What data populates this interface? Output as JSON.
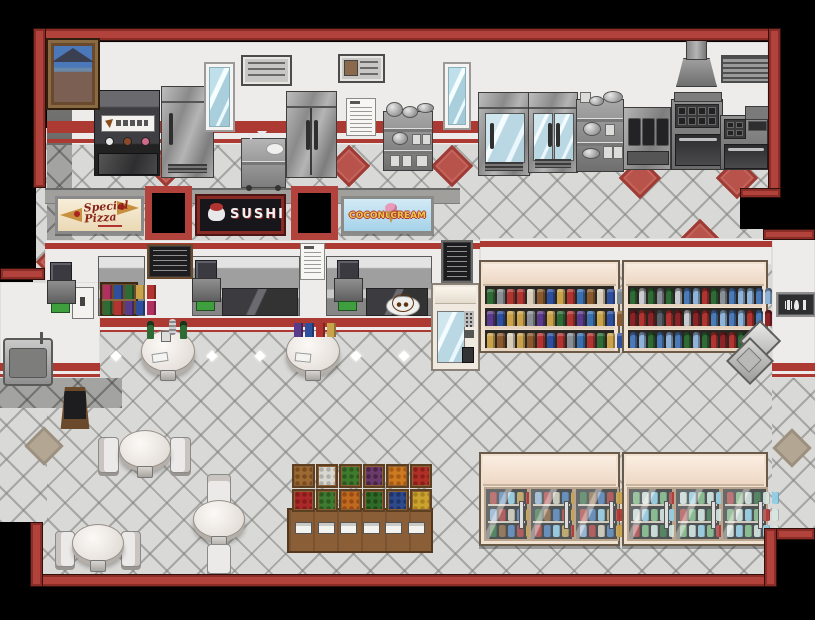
{
  "signs": {
    "pizza_line1": "Special",
    "pizza_line2": "Pizza",
    "sushi": "SUSHI",
    "icecream_left": "COCONUT",
    "icecream_right": "CREAM"
  },
  "palette": {
    "border_red": "#b2423c",
    "stripe_red": "#ad3a32",
    "wall_white": "#edecea",
    "floor_tile": "#d9d9d7",
    "dark_floor": "#a3a3a1",
    "wood": "#8a5f38",
    "shelf_frame": "#efe0d0",
    "chalkboard": "#1d1d1f",
    "steel": "#9a9a9a",
    "accent_diamond": "#b8534b"
  },
  "icons": {
    "wall_plaque_icons": [
      "fork-icon",
      "spoon-icon",
      "knife-icon"
    ],
    "icecream_machine_buttons": [
      "vanilla",
      "chocolate",
      "strawberry"
    ],
    "pizza_sign_icon": "pizza-slice-icon",
    "sushi_sign_icon": "sushi-icon",
    "icecream_sign_icon": "ice-cream-cone-icon"
  },
  "shop": {
    "grocery_shelf_rows": [
      [
        "#2e6b35",
        "#8a8f96",
        "#b23430",
        "#b23430",
        "#d8cdb8",
        "#8a5a2e",
        "#2e4f9e",
        "#caa24a",
        "#b23430",
        "#3a6fb0",
        "#8a5a2e",
        "#d8cdb8",
        "#2e4f9e",
        "#7a8894",
        "#b23430"
      ],
      [
        "#5a3a8a",
        "#2e4f9e",
        "#caa24a",
        "#caa24a",
        "#8a8f96",
        "#5a3a8a",
        "#caa24a",
        "#2e6b35",
        "#b23430",
        "#5a3a8a",
        "#3a6fb0",
        "#caa24a",
        "#2e4f9e",
        "#8a5a2e",
        "#b23430"
      ],
      [
        "#caa24a",
        "#8a5a2e",
        "#d8cdb8",
        "#caa24a",
        "#8a5a2e",
        "#b23430",
        "#2e4f9e",
        "#b23430",
        "#8a8f96",
        "#3a6fb0",
        "#b23430",
        "#2e6b35",
        "#caa24a",
        "#2e4f9e",
        "#b23430"
      ]
    ],
    "drink_shelf_rows": [
      [
        "#2e6b35",
        "#c8ccd0",
        "#2e6b35",
        "#8a9098",
        "#2e6b35",
        "#c8ccd0",
        "#4a7ab8",
        "#8fb2d8",
        "#b23430",
        "#2e6b35",
        "#8a9098",
        "#4a7ab8",
        "#8fb2d8",
        "#8fb2d8",
        "#4a7ab8",
        "#8fb2d8"
      ],
      [
        "#8a2328",
        "#b23430",
        "#8a2328",
        "#5a6068",
        "#b23430",
        "#8a2328",
        "#c8ccd0",
        "#8a2328",
        "#b23430",
        "#4a7ab8",
        "#8fb2d8",
        "#4a7ab8",
        "#8fb2d8",
        "#b23430",
        "#4a7ab8",
        "#8a2328"
      ],
      [
        "#4a7ab8",
        "#8fb2d8",
        "#2e6b35",
        "#4a7ab8",
        "#8fb2d8",
        "#4a7ab8",
        "#2e6b35",
        "#8fb2d8",
        "#2e6b35",
        "#b23430",
        "#8a2328",
        "#b23430",
        "#2e6b35",
        "#4a7ab8",
        "#8fb2d8",
        "#4a7ab8"
      ]
    ],
    "freezer_left_rows": [
      [
        "#b23430",
        "#4a7ab8",
        "#8fd0e8",
        "#caa24a",
        "#b23430",
        "#4a7ab8"
      ],
      [
        "#8fb2d8",
        "#b23430",
        "#d8cdb8",
        "#4a7ab8",
        "#caa24a",
        "#8fb2d8"
      ],
      [
        "#2e6b35",
        "#8a5a2e",
        "#4a7ab8",
        "#b23430",
        "#caa24a",
        "#2e6b35"
      ]
    ],
    "freezer_right_rows": [
      [
        "#7ab87a",
        "#d8e8e0",
        "#8fd0e8",
        "#7ab87a",
        "#b23430",
        "#d8e8e0"
      ],
      [
        "#d8e8e0",
        "#8fd0e8",
        "#7ab87a",
        "#d8e8e0",
        "#8fd0e8",
        "#d8e8e0"
      ],
      [
        "#b23430",
        "#7ab87a",
        "#d8e8e0",
        "#2e6b35",
        "#d8e8e0",
        "#8fd0e8"
      ]
    ],
    "produce_bins": [
      {
        "name": "onions",
        "base": "#9a6a32",
        "dot": "#7a4a1c"
      },
      {
        "name": "garlic",
        "base": "#d8d8d0",
        "dot": "#b0b0a8"
      },
      {
        "name": "cucumbers",
        "base": "#3f7a2e",
        "dot": "#2c5a1e"
      },
      {
        "name": "eggplants",
        "base": "#6a3a6a",
        "dot": "#4a2448"
      },
      {
        "name": "oranges",
        "base": "#cc7a22",
        "dot": "#a85a12"
      },
      {
        "name": "tomatoes",
        "base": "#b03028",
        "dot": "#8a1f1a"
      },
      {
        "name": "apples",
        "base": "#aa2828",
        "dot": "#841c1a"
      },
      {
        "name": "zucchini",
        "base": "#3e7a30",
        "dot": "#2a581f"
      },
      {
        "name": "carrots",
        "base": "#c06a20",
        "dot": "#9a4a12"
      },
      {
        "name": "green-beans",
        "base": "#2f6a28",
        "dot": "#1f4a18"
      },
      {
        "name": "blueberries",
        "base": "#2e4a8a",
        "dot": "#1e3468"
      },
      {
        "name": "bananas",
        "base": "#caa22e",
        "dot": "#a8821e"
      }
    ],
    "price_tag_count": 6,
    "bar_table_books": [
      "#5a3a8a",
      "#2e4f9e",
      "#b23430",
      "#caa24a"
    ],
    "counter_bookshelf_rows": [
      [
        "#b03060",
        "#2e4f9e",
        "#2e6b35",
        "#caa24a",
        "#b23430"
      ],
      [
        "#2e6b35",
        "#b23430",
        "#5a3a8a",
        "#2e4f9e",
        "#b03060"
      ]
    ]
  }
}
